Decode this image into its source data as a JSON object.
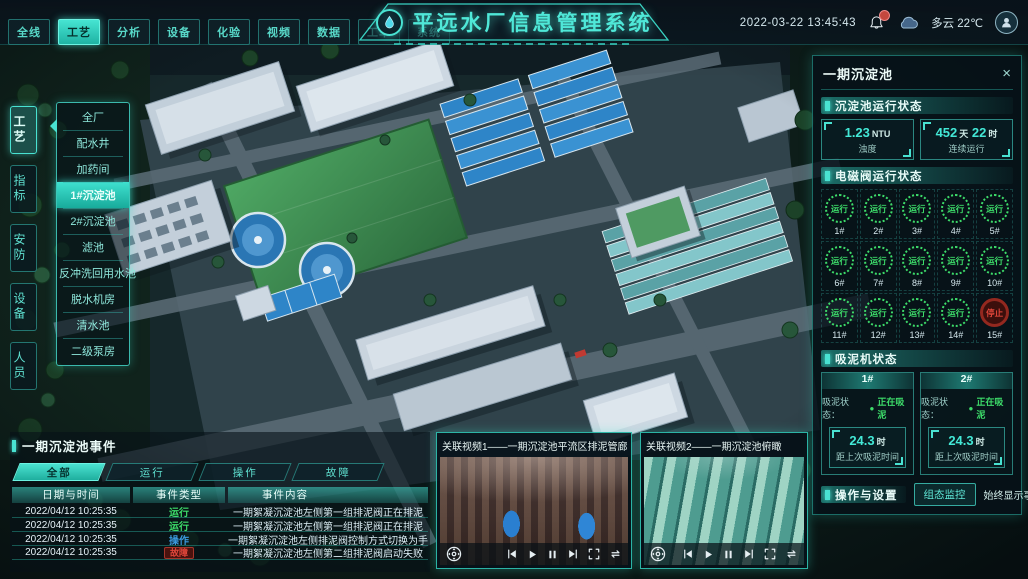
{
  "colors": {
    "accent": "#35dcc8",
    "green": "#3ddc6a",
    "red": "#e0463a",
    "blue": "#3b9ae0",
    "ink": "#eaf6f4"
  },
  "app": {
    "title": "平远水厂信息管理系统",
    "datetime": "2022-03-22 13:45:43",
    "weather": "多云 22℃"
  },
  "topnav": {
    "tabs": [
      {
        "label": "全线",
        "state": ""
      },
      {
        "label": "工艺",
        "state": "active"
      },
      {
        "label": "分析",
        "state": ""
      },
      {
        "label": "设备",
        "state": ""
      },
      {
        "label": "化验",
        "state": ""
      },
      {
        "label": "视频",
        "state": ""
      },
      {
        "label": "数据",
        "state": ""
      },
      {
        "label": "工单",
        "state": ""
      },
      {
        "label": "系统",
        "state": ""
      }
    ]
  },
  "sidebar": {
    "tabs": [
      {
        "label": "工艺",
        "state": "active"
      },
      {
        "label": "指标",
        "state": ""
      },
      {
        "label": "安防",
        "state": ""
      },
      {
        "label": "设备",
        "state": ""
      },
      {
        "label": "人员",
        "state": ""
      }
    ],
    "menu": [
      {
        "label": "全厂",
        "state": ""
      },
      {
        "label": "配水井",
        "state": ""
      },
      {
        "label": "加药间",
        "state": ""
      },
      {
        "label": "1#沉淀池",
        "state": "active"
      },
      {
        "label": "2#沉淀池",
        "state": ""
      },
      {
        "label": "滤池",
        "state": ""
      },
      {
        "label": "反冲洗回用水池",
        "state": ""
      },
      {
        "label": "脱水机房",
        "state": ""
      },
      {
        "label": "清水池",
        "state": ""
      },
      {
        "label": "二级泵房",
        "state": ""
      }
    ]
  },
  "panel": {
    "title": "一期沉淀池",
    "close": "×",
    "run_status": {
      "title": "沉淀池运行状态",
      "turbidity": {
        "value": "1.23",
        "unit": "NTU",
        "label": "浊度"
      },
      "uptime": {
        "days": "452",
        "days_unit": "天",
        "hours": "22",
        "hours_unit": "时",
        "label": "连续运行"
      }
    },
    "valves": {
      "title": "电磁阀运行状态",
      "items": [
        {
          "id": "1#",
          "status": "运行",
          "state": "run"
        },
        {
          "id": "2#",
          "status": "运行",
          "state": "run"
        },
        {
          "id": "3#",
          "status": "运行",
          "state": "run"
        },
        {
          "id": "4#",
          "status": "运行",
          "state": "run"
        },
        {
          "id": "5#",
          "status": "运行",
          "state": "run"
        },
        {
          "id": "6#",
          "status": "运行",
          "state": "run"
        },
        {
          "id": "7#",
          "status": "运行",
          "state": "run"
        },
        {
          "id": "8#",
          "status": "运行",
          "state": "run"
        },
        {
          "id": "9#",
          "status": "运行",
          "state": "run"
        },
        {
          "id": "10#",
          "status": "运行",
          "state": "run"
        },
        {
          "id": "11#",
          "status": "运行",
          "state": "run"
        },
        {
          "id": "12#",
          "status": "运行",
          "state": "run"
        },
        {
          "id": "13#",
          "status": "运行",
          "state": "run"
        },
        {
          "id": "14#",
          "status": "运行",
          "state": "run"
        },
        {
          "id": "15#",
          "status": "停止",
          "state": "stop"
        }
      ]
    },
    "mud": {
      "title": "吸泥机状态",
      "machines": [
        {
          "id": "1#",
          "status_label": "吸泥状态：",
          "dot": "●",
          "status": "正在吸泥",
          "value": "24.3",
          "unit": "时",
          "label": "距上次吸泥时间"
        },
        {
          "id": "2#",
          "status_label": "吸泥状态：",
          "dot": "●",
          "status": "正在吸泥",
          "value": "24.3",
          "unit": "时",
          "label": "距上次吸泥时间"
        }
      ]
    },
    "ops": {
      "title": "操作与设置",
      "button": "组态监控",
      "toggle_label": "始终显示事件："
    }
  },
  "events": {
    "title": "一期沉淀池事件",
    "tabs": [
      {
        "label": "全部",
        "state": "active"
      },
      {
        "label": "运行",
        "state": ""
      },
      {
        "label": "操作",
        "state": ""
      },
      {
        "label": "故障",
        "state": ""
      }
    ],
    "columns": [
      "日期与时间",
      "事件类型",
      "事件内容"
    ],
    "rows": [
      {
        "time": "2022/04/12 10:25:35",
        "type": "运行",
        "state": "run",
        "content": "一期絮凝沉淀池左侧第一组排泥阀正在排泥"
      },
      {
        "time": "2022/04/12 10:25:35",
        "type": "运行",
        "state": "run",
        "content": "一期絮凝沉淀池左侧第一组排泥阀正在排泥"
      },
      {
        "time": "2022/04/12 10:25:35",
        "type": "操作",
        "state": "op",
        "content": "一期絮凝沉淀池左侧排泥阀控制方式切换为手动"
      },
      {
        "time": "2022/04/12 10:25:35",
        "type": "故障",
        "state": "fault",
        "content": "一期絮凝沉淀池左侧第二组排泥阀启动失败"
      }
    ]
  },
  "videos": [
    {
      "title": "关联视频1——一期沉淀池平流区排泥管廊",
      "scene": "gallery"
    },
    {
      "title": "关联视频2——一期沉淀池俯瞰",
      "scene": "aerial"
    }
  ]
}
